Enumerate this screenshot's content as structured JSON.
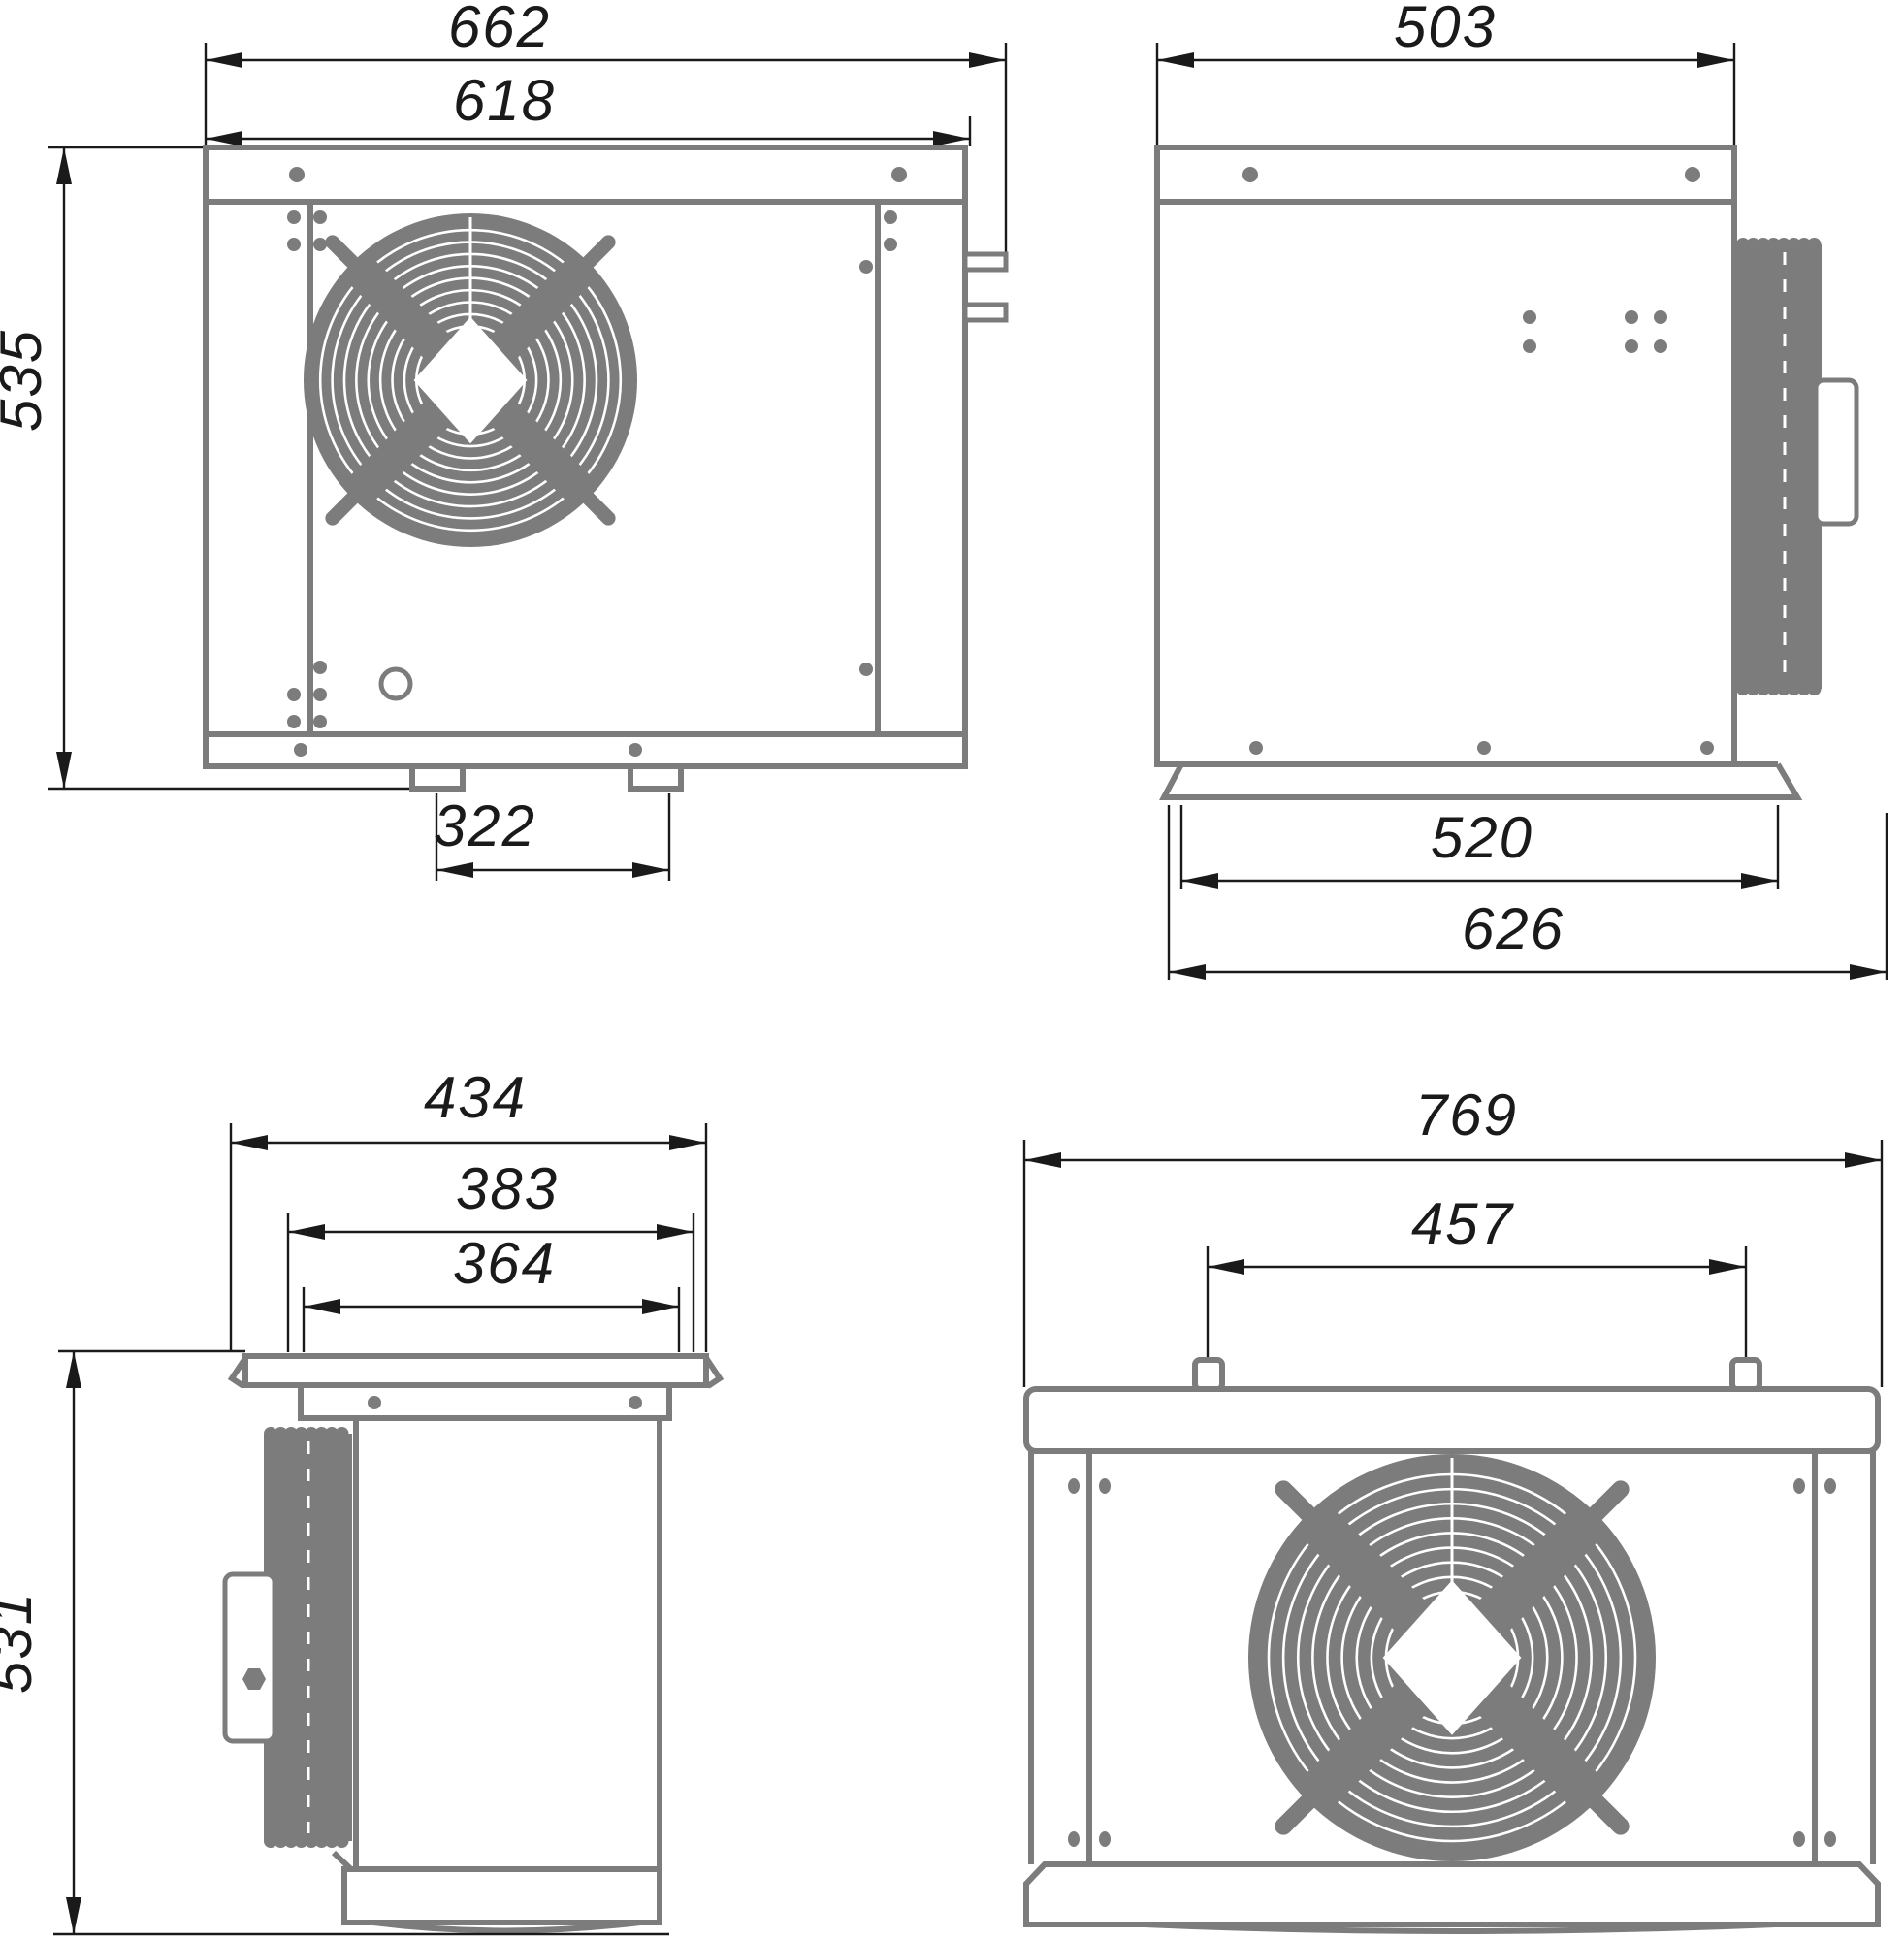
{
  "drawing": {
    "type": "technical-dimension-drawing",
    "subject": "condensing-unit-four-views",
    "views": {
      "front": {
        "dims": {
          "overall_width": "662",
          "body_width": "618",
          "height": "535",
          "feet_spacing": "322"
        }
      },
      "side": {
        "dims": {
          "depth": "503",
          "base_width": "520",
          "base_overall": "626"
        }
      },
      "left": {
        "dims": {
          "overall_depth": "434",
          "flange_depth": "383",
          "body_depth": "364",
          "height": "531"
        }
      },
      "back": {
        "dims": {
          "overall_width": "769",
          "hanger_spacing": "457"
        }
      }
    },
    "colors": {
      "object": "#7c7c7c",
      "dimension": "#1a1a1a",
      "background": "#ffffff"
    }
  }
}
